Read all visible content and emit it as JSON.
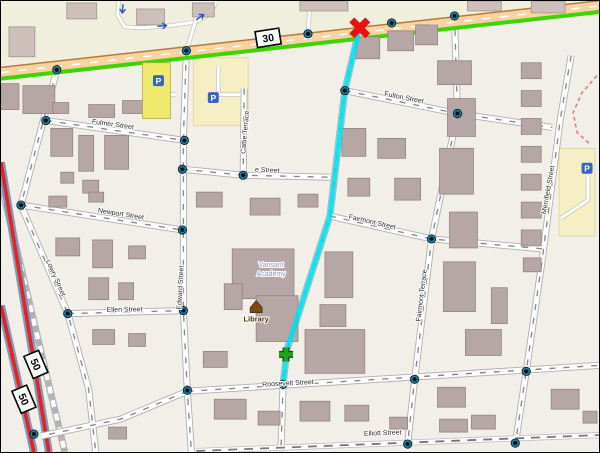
{
  "map": {
    "background_color": "#f2efe9",
    "colors": {
      "route_line": "#00dff0",
      "marker_red": "#ea1010",
      "marker_green": "#1fa41f",
      "highway_fill": "#fbd3a0",
      "highway_casing": "#b07c3e",
      "cycle_green_stripe": "#3fd400",
      "route50_red": "#e82020",
      "route50_casing": "#7e99b8",
      "railway_gray": "#b3b3b3",
      "building_fill": "#b6a6a6",
      "building_light_fill": "#cdbfba",
      "parking_fill": "#f6efc3",
      "commercial_fill": "#f0eedd",
      "label_color": "#2a2a2a",
      "parking_blue": "#3465c4",
      "library_brown": "#7a4a10",
      "academy_label_color": "#9095bb",
      "oneway_arrow_blue": "#2a52cc",
      "red_dashed": "#e87878"
    },
    "main_road": {
      "ref": "30",
      "points": [
        [
          0,
          72
        ],
        [
          600,
          5
        ]
      ],
      "green_stripe": [
        [
          0,
          78
        ],
        [
          600,
          11
        ]
      ]
    },
    "route_shields": [
      {
        "text": "30",
        "x": 268,
        "y": 37,
        "rotate": -9
      },
      {
        "text": "50",
        "x": 35,
        "y": 365,
        "rotate": 67
      },
      {
        "text": "50",
        "x": 23,
        "y": 400,
        "rotate": 67
      }
    ],
    "streets": [
      {
        "name": "Fulmer Street",
        "style": "res",
        "points": [
          [
            45,
            120
          ],
          [
            184,
            140
          ]
        ],
        "label": {
          "x": 112,
          "y": 126,
          "rotate": 8
        }
      },
      {
        "name": "Newport Street",
        "style": "res",
        "points": [
          [
            20,
            205
          ],
          [
            182,
            230
          ]
        ],
        "label": {
          "x": 120,
          "y": 216,
          "rotate": 9
        }
      },
      {
        "name": "Ellen Street",
        "style": "res",
        "points": [
          [
            67,
            314
          ],
          [
            183,
            311
          ]
        ],
        "label": {
          "x": 124,
          "y": 312,
          "rotate": -1
        }
      },
      {
        "name": "Lowry Street",
        "style": "res",
        "points": [
          [
            56,
            69
          ],
          [
            20,
            205
          ],
          [
            67,
            314
          ],
          [
            88,
            390
          ],
          [
            95,
            453
          ]
        ],
        "label": {
          "x": 53,
          "y": 279,
          "rotate": 66
        }
      },
      {
        "name": "Edward Street",
        "style": "res",
        "points": [
          [
            186,
            50
          ],
          [
            183,
            138
          ],
          [
            183,
            311
          ],
          [
            187,
            392
          ],
          [
            191,
            453
          ]
        ],
        "label": {
          "x": 182,
          "y": 288,
          "rotate": -87
        }
      },
      {
        "name": "e Street",
        "style": "res",
        "points": [
          [
            182,
            169
          ],
          [
            243,
            175
          ],
          [
            330,
            177
          ]
        ],
        "label": {
          "x": 267,
          "y": 172,
          "rotate": 3
        }
      },
      {
        "name": "Cattie Terrace",
        "style": "res",
        "points": [
          [
            244,
            88
          ],
          [
            243,
            175
          ]
        ],
        "label": {
          "x": 247,
          "y": 132,
          "rotate": -85
        }
      },
      {
        "name": "Fulton Street",
        "style": "res",
        "points": [
          [
            345,
            90
          ],
          [
            458,
            113
          ],
          [
            553,
            127
          ]
        ],
        "label": {
          "x": 404,
          "y": 99,
          "rotate": 11
        }
      },
      {
        "name": "Fairmont Street",
        "style": "res",
        "points": [
          [
            330,
            216
          ],
          [
            432,
            239
          ],
          [
            544,
            249
          ]
        ],
        "label": {
          "x": 372,
          "y": 224,
          "rotate": 13
        }
      },
      {
        "name": "Fairmont Terrace",
        "style": "res",
        "points": [
          [
            455,
            15
          ],
          [
            458,
            113
          ],
          [
            432,
            239
          ],
          [
            415,
            380
          ],
          [
            408,
            445
          ]
        ],
        "label": {
          "x": 424,
          "y": 296,
          "rotate": -83
        }
      },
      {
        "name": "Merrifield Street",
        "style": "res",
        "points": [
          [
            572,
            55
          ],
          [
            561,
            120
          ],
          [
            543,
            260
          ],
          [
            527,
            372
          ],
          [
            516,
            445
          ]
        ],
        "label": {
          "x": 551,
          "y": 190,
          "rotate": -80
        }
      },
      {
        "name": "Roosevelt Street",
        "style": "res",
        "points": [
          [
            187,
            392
          ],
          [
            600,
            366
          ]
        ],
        "label": {
          "x": 288,
          "y": 386,
          "rotate": -3
        }
      },
      {
        "name": "Elliott Street",
        "style": "track",
        "points": [
          [
            196,
            452
          ],
          [
            600,
            436
          ]
        ],
        "label": {
          "x": 383,
          "y": 436,
          "rotate": -2
        }
      },
      {
        "name": "",
        "style": "res",
        "points": [
          [
            359,
            30
          ],
          [
            345,
            90
          ],
          [
            330,
            216
          ],
          [
            287,
            350
          ],
          [
            283,
            385
          ],
          [
            281,
            448
          ]
        ]
      },
      {
        "name": "",
        "style": "res",
        "points": [
          [
            187,
            392
          ],
          [
            120,
            420
          ],
          [
            40,
            437
          ]
        ]
      }
    ],
    "service_roads": [
      [
        [
          118,
          0
        ],
        [
          117,
          14
        ],
        [
          124,
          26
        ],
        [
          140,
          27
        ],
        [
          168,
          25
        ],
        [
          196,
          21
        ],
        [
          210,
          13
        ],
        [
          216,
          0
        ]
      ],
      [
        [
          196,
          18
        ],
        [
          186,
          50
        ]
      ],
      [
        [
          308,
          33
        ],
        [
          310,
          0
        ]
      ],
      [
        [
          218,
          66
        ],
        [
          218,
          94
        ],
        [
          246,
          94
        ]
      ],
      [
        [
          160,
          68
        ],
        [
          160,
          94
        ]
      ],
      [
        [
          147,
          94
        ],
        [
          175,
          94
        ]
      ],
      [
        [
          589,
          176
        ],
        [
          589,
          200
        ],
        [
          562,
          218
        ]
      ]
    ],
    "route50_lines": [
      [
        [
          0,
          306
        ],
        [
          33,
          453
        ]
      ],
      [
        [
          0,
          162
        ],
        [
          48,
          453
        ]
      ]
    ],
    "railway": [
      [
        0,
        183
      ],
      [
        64,
        453
      ]
    ],
    "red_dashed_line": [
      [
        598,
        75
      ],
      [
        583,
        92
      ],
      [
        574,
        112
      ],
      [
        578,
        132
      ],
      [
        590,
        143
      ]
    ],
    "commercial_band": [
      [
        0,
        0
      ],
      [
        600,
        0
      ],
      [
        600,
        10
      ],
      [
        0,
        77
      ]
    ],
    "parking_lots": [
      [
        193,
        57,
        55,
        68
      ],
      [
        560,
        148,
        36,
        88
      ]
    ],
    "yellow_buildings": [
      [
        142,
        62,
        28,
        56
      ]
    ],
    "academy_buildings": [
      [
        232,
        249,
        62,
        50
      ],
      [
        256,
        296,
        42,
        46
      ],
      [
        224,
        284,
        18,
        26
      ]
    ],
    "buildings_light": [
      [
        8,
        26,
        26,
        30
      ],
      [
        66,
        2,
        30,
        16
      ],
      [
        136,
        8,
        28,
        16
      ],
      [
        192,
        2,
        22,
        14
      ],
      [
        300,
        0,
        48,
        10
      ],
      [
        468,
        0,
        34,
        10
      ],
      [
        532,
        0,
        34,
        12
      ]
    ],
    "buildings": [
      [
        0,
        83,
        18,
        26
      ],
      [
        22,
        85,
        32,
        28
      ],
      [
        52,
        102,
        16,
        11
      ],
      [
        88,
        104,
        26,
        13
      ],
      [
        122,
        100,
        20,
        13
      ],
      [
        50,
        128,
        22,
        28
      ],
      [
        78,
        135,
        15,
        36
      ],
      [
        104,
        135,
        24,
        34
      ],
      [
        60,
        172,
        13,
        11
      ],
      [
        82,
        180,
        16,
        13
      ],
      [
        48,
        196,
        18,
        11
      ],
      [
        88,
        192,
        15,
        10
      ],
      [
        55,
        238,
        24,
        18
      ],
      [
        92,
        240,
        20,
        28
      ],
      [
        128,
        246,
        17,
        13
      ],
      [
        88,
        278,
        20,
        22
      ],
      [
        118,
        283,
        15,
        17
      ],
      [
        92,
        330,
        22,
        15
      ],
      [
        128,
        334,
        17,
        13
      ],
      [
        108,
        428,
        18,
        12
      ],
      [
        196,
        192,
        26,
        15
      ],
      [
        250,
        198,
        30,
        17
      ],
      [
        298,
        194,
        20,
        13
      ],
      [
        203,
        352,
        24,
        16
      ],
      [
        214,
        400,
        32,
        20
      ],
      [
        258,
        412,
        22,
        14
      ],
      [
        300,
        402,
        30,
        20
      ],
      [
        345,
        406,
        24,
        16
      ],
      [
        356,
        36,
        24,
        22
      ],
      [
        388,
        30,
        26,
        20
      ],
      [
        416,
        24,
        22,
        20
      ],
      [
        342,
        128,
        24,
        28
      ],
      [
        378,
        138,
        28,
        20
      ],
      [
        348,
        178,
        22,
        18
      ],
      [
        395,
        178,
        26,
        22
      ],
      [
        325,
        252,
        28,
        46
      ],
      [
        320,
        305,
        26,
        22
      ],
      [
        305,
        330,
        60,
        44
      ],
      [
        438,
        60,
        34,
        24
      ],
      [
        448,
        98,
        28,
        38
      ],
      [
        440,
        148,
        34,
        46
      ],
      [
        450,
        212,
        28,
        36
      ],
      [
        444,
        262,
        32,
        50
      ],
      [
        492,
        288,
        16,
        36
      ],
      [
        466,
        330,
        36,
        26
      ],
      [
        438,
        388,
        28,
        20
      ],
      [
        390,
        418,
        18,
        12
      ],
      [
        440,
        420,
        28,
        13
      ],
      [
        472,
        416,
        24,
        14
      ],
      [
        522,
        62,
        20,
        16
      ],
      [
        522,
        90,
        20,
        16
      ],
      [
        522,
        118,
        20,
        16
      ],
      [
        522,
        146,
        20,
        16
      ],
      [
        522,
        174,
        20,
        16
      ],
      [
        522,
        202,
        20,
        16
      ],
      [
        522,
        230,
        20,
        16
      ],
      [
        524,
        258,
        18,
        14
      ],
      [
        552,
        390,
        28,
        20
      ],
      [
        584,
        412,
        14,
        12
      ]
    ],
    "nodes": [
      [
        56,
        69
      ],
      [
        186,
        50
      ],
      [
        308,
        33
      ],
      [
        392,
        22
      ],
      [
        455,
        15
      ],
      [
        45,
        120
      ],
      [
        184,
        140
      ],
      [
        182,
        169
      ],
      [
        243,
        175
      ],
      [
        20,
        205
      ],
      [
        182,
        230
      ],
      [
        67,
        314
      ],
      [
        183,
        311
      ],
      [
        345,
        90
      ],
      [
        458,
        113
      ],
      [
        432,
        239
      ],
      [
        283,
        385
      ],
      [
        187,
        391
      ],
      [
        415,
        380
      ],
      [
        527,
        372
      ],
      [
        408,
        445
      ],
      [
        516,
        444
      ],
      [
        33,
        435
      ]
    ],
    "oneway_arrows": [
      {
        "x": 122,
        "y": 8,
        "rotate": 95
      },
      {
        "x": 162,
        "y": 25,
        "rotate": -5
      },
      {
        "x": 200,
        "y": 16,
        "rotate": -35
      }
    ],
    "pois": {
      "library": {
        "label": "Library",
        "x": 256,
        "y": 322,
        "icon_x": 256,
        "icon_y": 306
      },
      "academy": {
        "line1": "Vansant",
        "line2": "Academy",
        "x": 271,
        "y": 267
      },
      "parking_icons": [
        {
          "x": 158,
          "y": 80
        },
        {
          "x": 213,
          "y": 97
        },
        {
          "x": 588,
          "y": 168
        }
      ]
    },
    "route": {
      "points": [
        [
          359,
          30
        ],
        [
          345,
          90
        ],
        [
          330,
          216
        ],
        [
          287,
          350
        ],
        [
          283,
          385
        ]
      ]
    },
    "markers": {
      "red_x": {
        "x": 360,
        "y": 27
      },
      "green_plus": {
        "x": 286,
        "y": 355
      }
    }
  }
}
